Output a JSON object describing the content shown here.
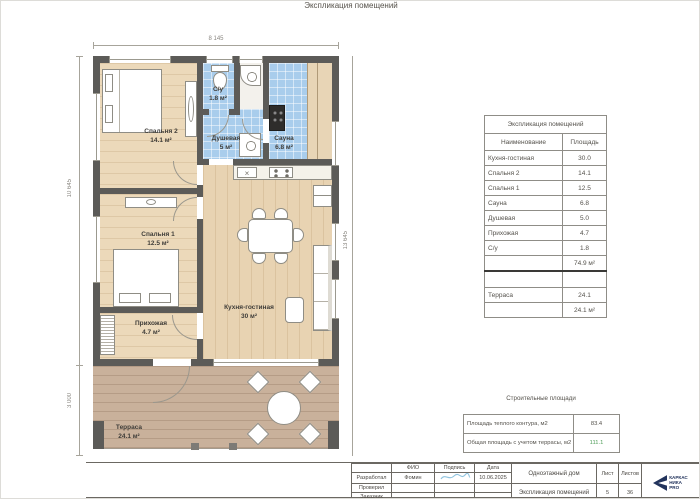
{
  "page_title": "Экспликация помещений",
  "plan": {
    "dims": {
      "top": "8 145",
      "left_upper": "10 645",
      "left_lower": "3 000",
      "right": "13 645"
    },
    "icons": {
      "sink": "×"
    },
    "rooms": {
      "bedroom2": {
        "name": "Спальня 2",
        "area": "14.1 м²"
      },
      "wc": {
        "name": "С/у",
        "area": "1.8 м²"
      },
      "shower": {
        "name": "Душевая",
        "area": "5 м²"
      },
      "sauna": {
        "name": "Сауна",
        "area": "6.8 м²"
      },
      "bedroom1": {
        "name": "Спальня 1",
        "area": "12.5 м²"
      },
      "hallway": {
        "name": "Прихожая",
        "area": "4.7 м²"
      },
      "kitchen": {
        "name": "Кухня-гостиная",
        "area": "30 м²"
      },
      "terrace": {
        "name": "Терраса",
        "area": "24.1 м²"
      }
    }
  },
  "explication": {
    "title": "Экспликация помещений",
    "col_name": "Наименование",
    "col_area": "Площадь",
    "rows": [
      [
        "Кухня-гостиная",
        "30.0"
      ],
      [
        "Спальня 2",
        "14.1"
      ],
      [
        "Спальня 1",
        "12.5"
      ],
      [
        "Сауна",
        "6.8"
      ],
      [
        "Душевая",
        "5.0"
      ],
      [
        "Прихожая",
        "4.7"
      ],
      [
        "С/у",
        "1.8"
      ]
    ],
    "subtotal": "74.9 м²",
    "terrace_name": "Терраса",
    "terrace_area": "24.1",
    "terrace_total": "24.1 м²"
  },
  "construction": {
    "title": "Строительные площади",
    "row1_label": "Площадь теплого контура, м2",
    "row1_value": "83.4",
    "row2_label": "Общая площадь с учетом террасы, м2",
    "row2_value": "111.1"
  },
  "title_block": {
    "fio_header": "ФИО",
    "sign_header": "Подпись",
    "date_header": "Дата",
    "row1_role": "Разработал",
    "row1_name": "Фомин",
    "row1_date": "10.06.2025",
    "row2_role": "Проверил",
    "row3_role": "Заказчик",
    "project": "Одноэтажный дом",
    "doc_title": "Экспликация помещений",
    "sheet_label": "Лист",
    "sheets_label": "Листов",
    "sheet": "5",
    "sheets": "36",
    "logo_line1": "КАРКАС",
    "logo_line2": "НИКА",
    "logo_line3": "PRO"
  },
  "colors": {
    "wall": "#5c5b58",
    "tile": "#a9cdec",
    "wood": "#ecd9ba",
    "terrace_wood": "#c9b19b",
    "total_green": "#4e9d58",
    "signature_blue": "#8fc3de",
    "logo_navy": "#22335c"
  }
}
